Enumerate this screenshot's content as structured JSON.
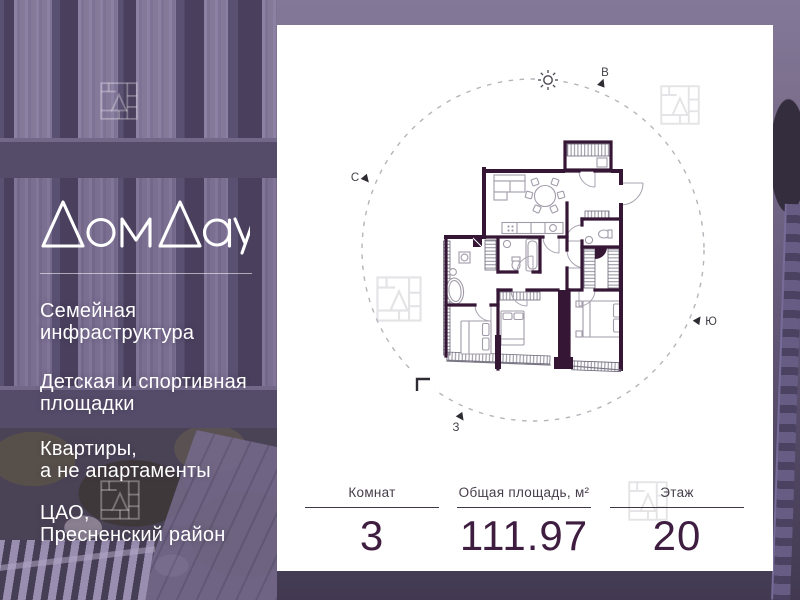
{
  "brand": {
    "logo_text": "ДомДау",
    "features": [
      "Семейная\nинфраструктура",
      "Детская и спортивная\nплощадки",
      "Квартиры,\nа не апартаменты",
      "ЦАО,\nПресненский район"
    ]
  },
  "plan": {
    "compass": {
      "north": "С",
      "east": "В",
      "south": "Ю",
      "west": "З"
    }
  },
  "stats": {
    "rooms": {
      "label": "Комнат",
      "value": "3"
    },
    "area": {
      "label": "Общая площадь, м²",
      "value": "111.97"
    },
    "floor": {
      "label": "Этаж",
      "value": "20"
    }
  },
  "colors": {
    "wall": "#351635",
    "number_text": "#3f1d40",
    "card_bg": "#ffffff",
    "watermark_card": "#e4e3e6"
  }
}
